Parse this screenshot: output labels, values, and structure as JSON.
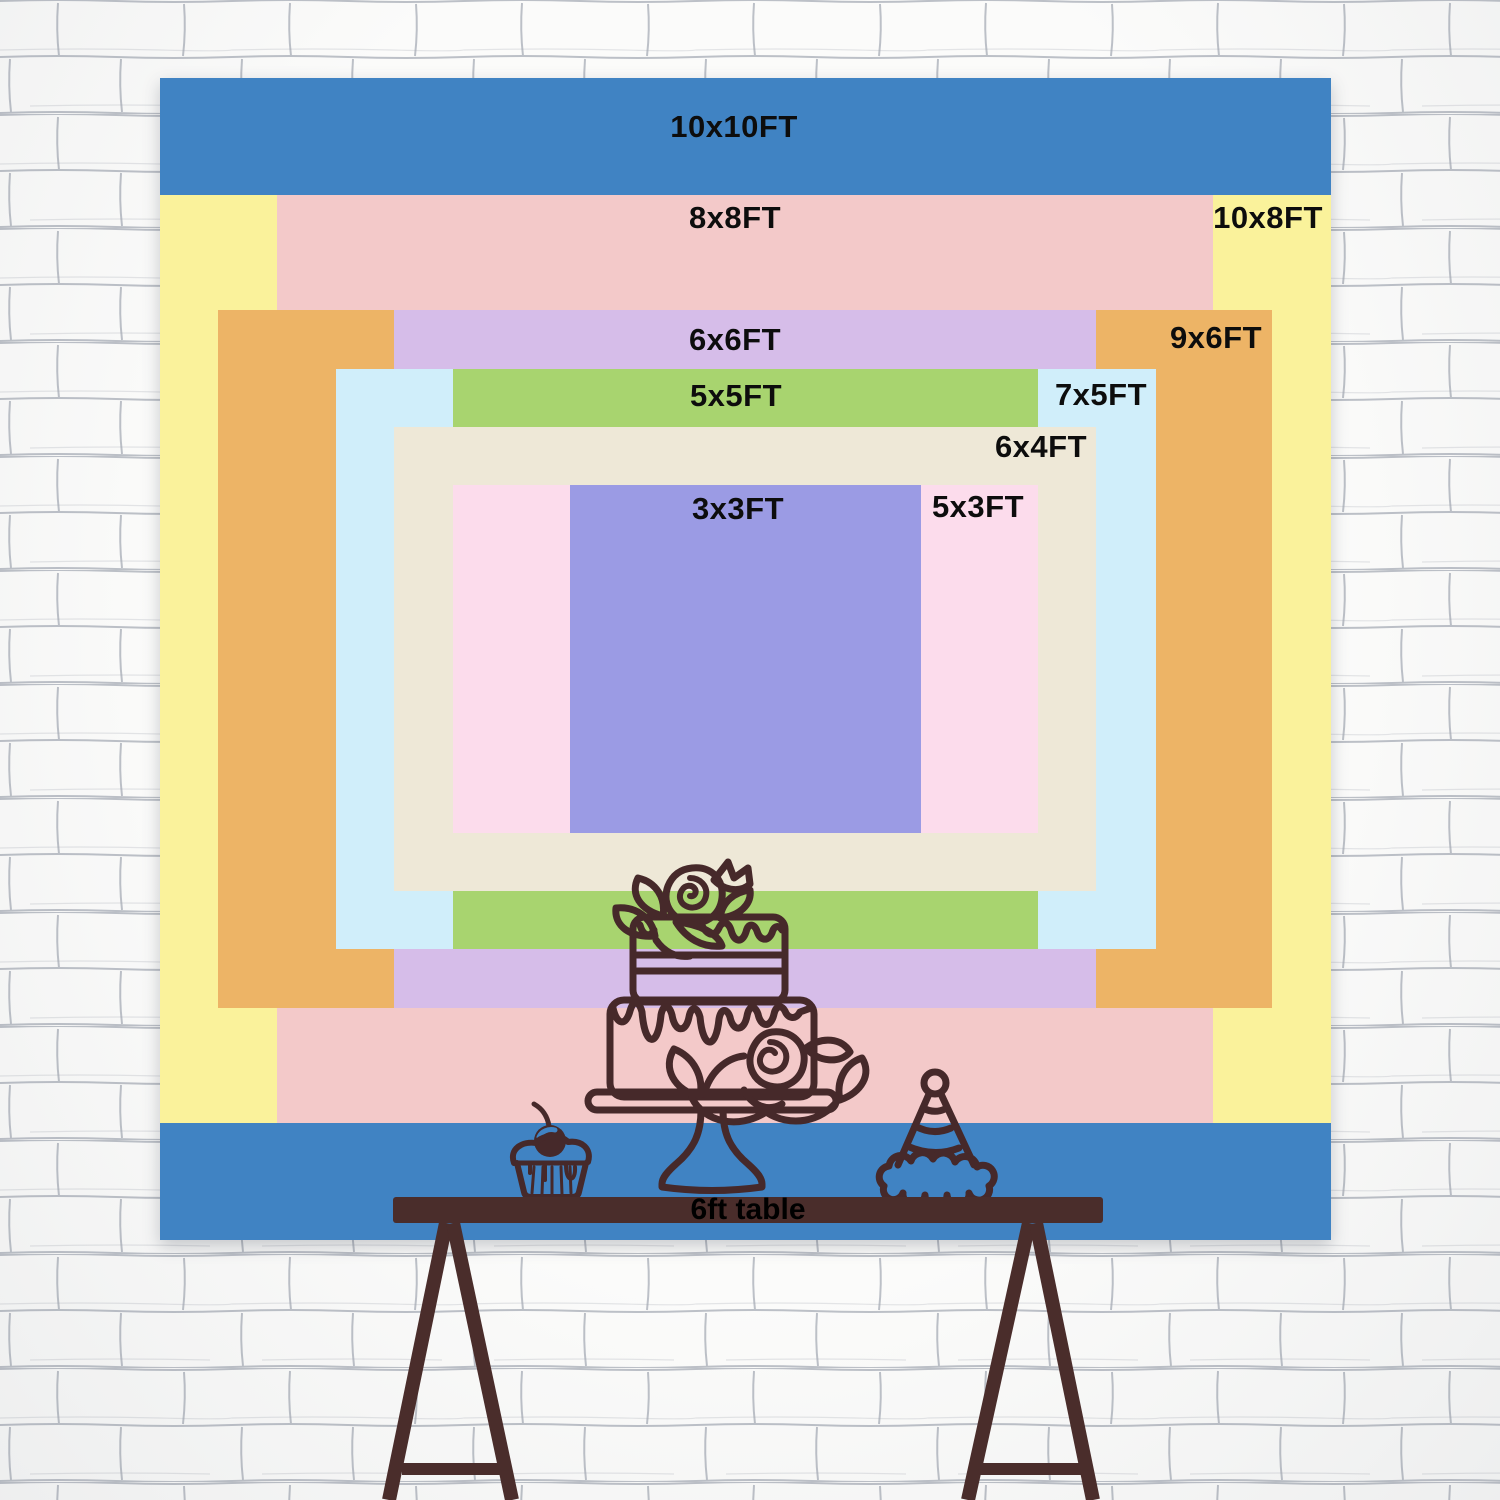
{
  "scene": {
    "background": "white-brick-wall",
    "wall_bg_color": "#fbfbfa",
    "wall_line_color": "#9aa0ac"
  },
  "size_chart": {
    "unit": "FT",
    "text_color": "#0d0d0d",
    "sizes": [
      {
        "id": "10x10",
        "label": "10x10FT",
        "width_ft": 10,
        "height_ft": 10,
        "color": "#4083c3"
      },
      {
        "id": "8x8",
        "label": "8x8FT",
        "width_ft": 8,
        "height_ft": 8,
        "color": "#f3c9c9"
      },
      {
        "id": "10x8",
        "label": "10x8FT",
        "width_ft": 10,
        "height_ft": 8,
        "color": "#faf29b"
      },
      {
        "id": "6x6",
        "label": "6x6FT",
        "width_ft": 6,
        "height_ft": 6,
        "color": "#d6bde9"
      },
      {
        "id": "9x6",
        "label": "9x6FT",
        "width_ft": 9,
        "height_ft": 6,
        "color": "#edb466"
      },
      {
        "id": "5x5",
        "label": "5x5FT",
        "width_ft": 5,
        "height_ft": 5,
        "color": "#a8d46f"
      },
      {
        "id": "7x5",
        "label": "7x5FT",
        "width_ft": 7,
        "height_ft": 5,
        "color": "#d0eefa"
      },
      {
        "id": "6x4",
        "label": "6x4FT",
        "width_ft": 6,
        "height_ft": 4,
        "color": "#eee8d7"
      },
      {
        "id": "3x3",
        "label": "3x3FT",
        "width_ft": 3,
        "height_ft": 3,
        "color": "#9b9be4"
      },
      {
        "id": "5x3",
        "label": "5x3FT",
        "width_ft": 5,
        "height_ft": 3,
        "color": "#fcdcec"
      }
    ]
  },
  "table": {
    "label": "6ft table",
    "color": "#4a2d2b",
    "label_color": "#000000"
  },
  "decorations": {
    "outline_color": "#46292a",
    "items": [
      "two-tier-cake-on-stand",
      "cupcake-with-cherry",
      "party-hat"
    ]
  }
}
